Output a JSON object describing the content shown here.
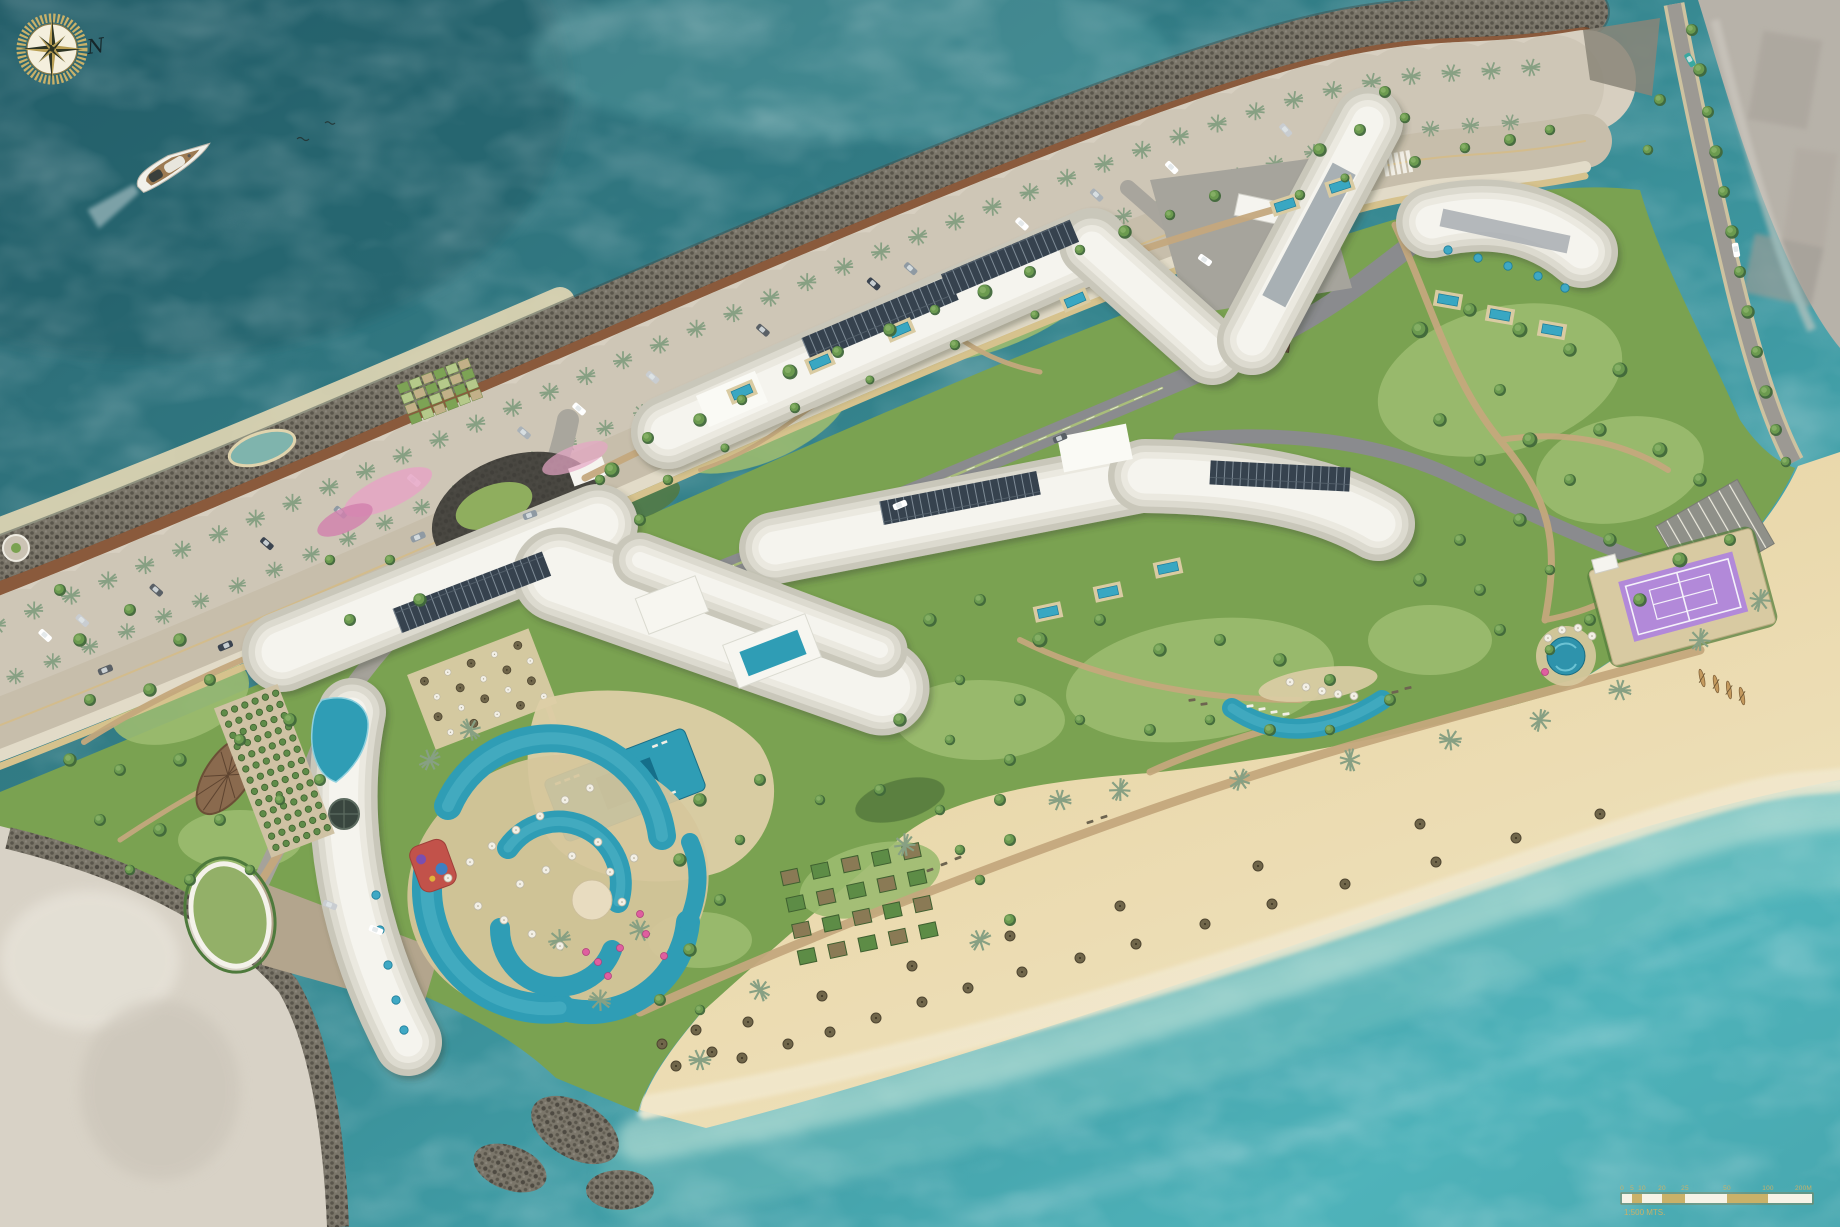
{
  "meta": {
    "type": "architectural-master-plan-aerial-rendering",
    "subject": "beachfront-resort-site-plan",
    "orientation": "north-up-left"
  },
  "compass": {
    "label": "N"
  },
  "scale_bar": {
    "labels": [
      "0",
      "5",
      "10",
      "20",
      "25",
      "50",
      "100",
      "200M"
    ],
    "caption": "1:500 MTS."
  },
  "icons": {
    "compass-rose-icon": "gold ring with dark 8-point star",
    "sailboat-icon": "white yacht seen from above with wake",
    "palm-tree-icon": "radial frond glyph",
    "tree-icon": "round canopy",
    "beach-umbrella-icon": "thatch / white / pink parasol dots",
    "kayak-icon": "small tan hulls on beach",
    "car-icon": "rounded rectangle vehicles",
    "tennis-court": "purple court with white lines",
    "swimming-pool": "turquoise water shapes",
    "scale-bar-icon": "alternating gold and white bar"
  },
  "colors": {
    "water_deep": "#2a6570",
    "water_mid": "#3c96a0",
    "water_bright": "#4fb3ba",
    "water_shallow": "#a8d8cf",
    "sand": "#ead9ad",
    "sand_dark": "#dcc893",
    "mainland_sw": "#d8d2c6",
    "mainland_ne": "#b7b2a9",
    "rock": "#716c60",
    "boardwalk": "#744a2e",
    "promenade": "#d7cfc0",
    "road_surface": "#c7beab",
    "khaki_strip": "#d6c28d",
    "road_internal": "#8a8b8e",
    "plaza_gray": "#a5a29a",
    "entry_dark": "#3e3d38",
    "grass": "#7aa251",
    "grass_light": "#9cbb70",
    "shrub": "#54793c",
    "tree": "#5d8c46",
    "path_tan": "#c4a87d",
    "building": "#f2f1ea",
    "solar_panel": "#36424e",
    "pool": "#2f9db5",
    "pool_deep": "#156f8a",
    "tennis_purple": "#b289d9",
    "tennis_apron": "#d8caa2",
    "gold": "#c9b169",
    "umbrella_thatch": "#6f654a",
    "umbrella_pink": "#df5f9f",
    "flower_pink": "#e5a5c4",
    "compass_dark": "#2e3524"
  }
}
